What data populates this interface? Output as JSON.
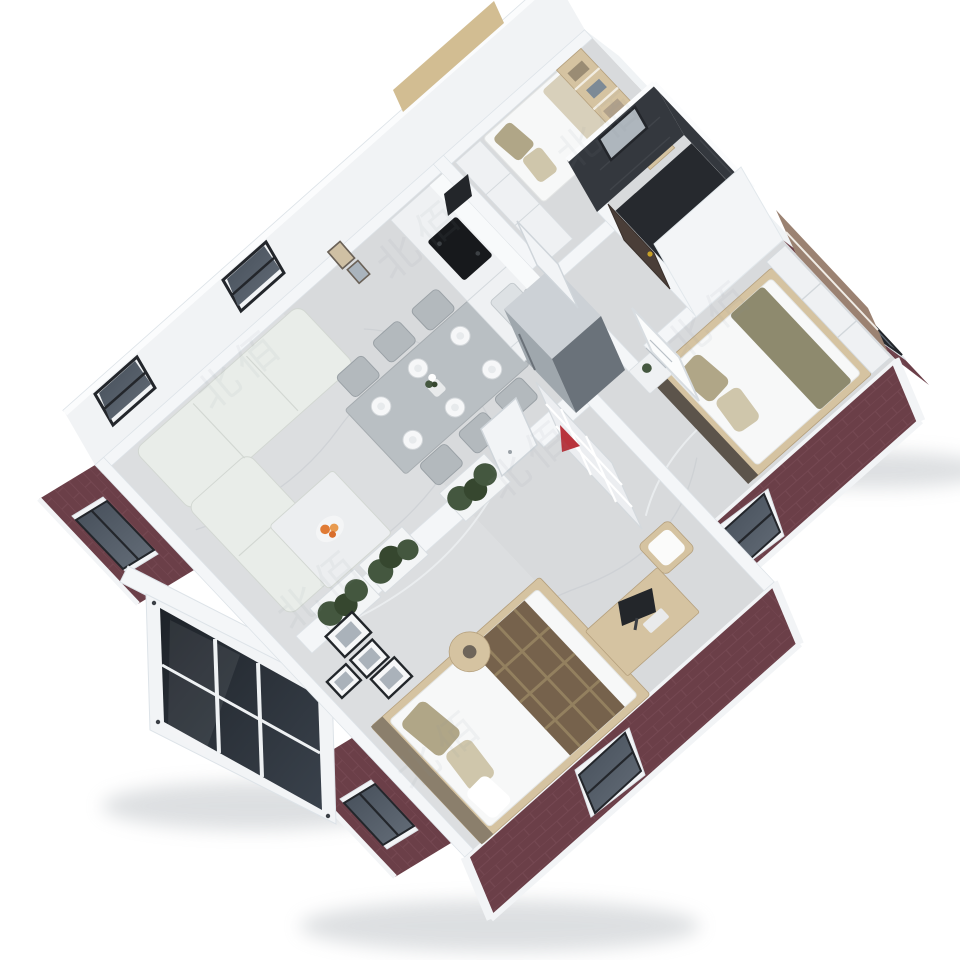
{
  "scene": {
    "title": "3D isometric cutaway render of an expandable container house floor plan",
    "style": "photoreal top-down 3D render on white background",
    "house": {
      "exterior_finish": "dark maroon brick panels with white steel container frame trim",
      "roof": "removed (cutaway) to show interior",
      "entrance": "black-glass sliding door module protruding from front-left wall",
      "floor_finish": "light gray marble tile"
    },
    "rooms": [
      {
        "name": "living-room",
        "contents": [
          "l-shaped-sectional-sofa",
          "coffee-table",
          "orange-flower-centerpiece",
          "window"
        ]
      },
      {
        "name": "dining-area",
        "contents": [
          "gray-dining-table",
          "six-chairs",
          "six-place-settings",
          "flower-vase",
          "window",
          "two-small-wall-art-frames"
        ]
      },
      {
        "name": "kitchen",
        "contents": [
          "white-cabinet-run",
          "black-cooktop",
          "sink-with-faucet",
          "stainless-refrigerator"
        ]
      },
      {
        "name": "study-bedroom",
        "contents": [
          "white-wardrobe",
          "single-bed-with-cushions",
          "wood-bookshelf",
          "wall-tv",
          "white-door"
        ]
      },
      {
        "name": "bathroom",
        "contents": [
          "dark-charcoal-tile-walls",
          "dark-tile-floor",
          "frosted-window",
          "dark-brown-door-with-gold-knob"
        ]
      },
      {
        "name": "master-bedroom",
        "contents": [
          "double-bed-white-duvet",
          "olive-pillows-and-throw",
          "dark-headboard",
          "nightstand-with-plant",
          "white-wall-art-frame",
          "low-white-dresser",
          "brown-wall-panel-shelf"
        ]
      },
      {
        "name": "second-bedroom",
        "contents": [
          "double-bed-with-plaid-runner",
          "khaki-pillows",
          "wood-desk",
          "monitor",
          "wood-chair-with-white-cushion",
          "round-side-table",
          "white-cube-shelf-with-red-ornament",
          "gallery-wall-black-frames",
          "white-door"
        ]
      },
      {
        "name": "hallway",
        "contents": [
          "half-wall-planters-with-green-hedges"
        ]
      }
    ],
    "window_count": 9,
    "dining_seats": 6,
    "place_settings": 6
  },
  "watermark": {
    "text": "北佰"
  },
  "colors": {
    "bg": "#ffffff",
    "back_wall": "#f1f3f5",
    "wall": "#f4f6f8",
    "wall_top": "#fbfcfd",
    "wall_edge": "#dde3e8",
    "floor": "#d8dadc",
    "floor_light": "#e0e2e4",
    "vein": "#c6cacf",
    "vein_light": "#eef0f2",
    "brick": "#6b3f48",
    "brick_line": "#9b707833",
    "frame_white": "#f2f4f6",
    "frame_dark": "#23262b",
    "glass_a": "#454e59",
    "glass_b": "#656e79",
    "module_glass_a": "#1d2228",
    "module_glass_b": "#3a424c",
    "sofa": "#e9ede9",
    "sofa_line": "#d2d7d2",
    "coffee_table": "#eceef0",
    "flower_orange": "#e07b35",
    "table_gray": "#b9bfc3",
    "chair_gray": "#b3b9bd",
    "plate": "#f6f7f8",
    "cabinet": "#eff1f3",
    "cooktop": "#17191c",
    "sink": "#dde1e4",
    "fridge_front": "#9fa7ad",
    "fridge_side": "#6a727a",
    "fridge_top": "#ccd1d6",
    "wood": "#d5c3a1",
    "wood_dark": "#b49f7c",
    "wood_tan": "#d2bd92",
    "duvet": "#f7f8f8",
    "pillow_khaki": "#b0a687",
    "pillow_light": "#cfc6ab",
    "olive": "#8e8a6e",
    "plaid": "#76624c",
    "plaid_line": "#93805f",
    "hedge": "#44573f",
    "hedge_dark": "#36472f",
    "planter": "#f3f5f6",
    "bath_wall": "#34383e",
    "bath_floor": "#26292e",
    "bath_window": "#aeb6bd",
    "door_brown": "#4a3e38",
    "gold": "#c9a227",
    "red_accent": "#b8343c",
    "monitor": "#23262a",
    "panel_brown": "#9b8272",
    "shadow": "#aab0b6",
    "watermark": "#8a939c"
  }
}
